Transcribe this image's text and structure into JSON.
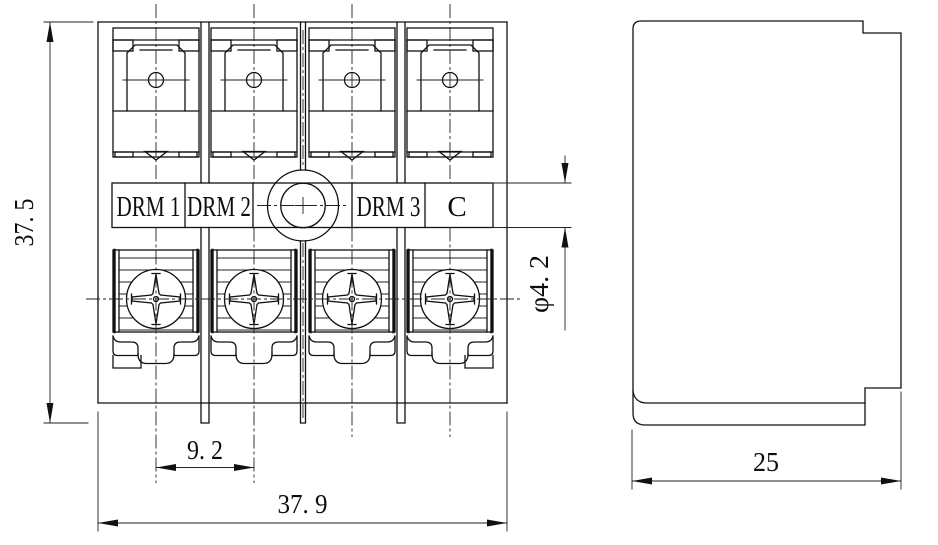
{
  "marking_strip": {
    "labels": [
      "DRM 1",
      "DRM 2",
      "DRM 3",
      "C"
    ]
  },
  "dimensions": {
    "overall_height": {
      "text": "37. 5",
      "value": 37.5
    },
    "terminal_pitch": {
      "text": "9. 2",
      "value": 9.2
    },
    "overall_width": {
      "text": "37. 9",
      "value": 37.9
    },
    "mounting_hole_diameter": {
      "text": "φ4. 2",
      "value": 4.2
    },
    "side_depth": {
      "text": "25",
      "value": 25
    }
  },
  "colors": {
    "line": "#111111",
    "background": "#ffffff"
  }
}
